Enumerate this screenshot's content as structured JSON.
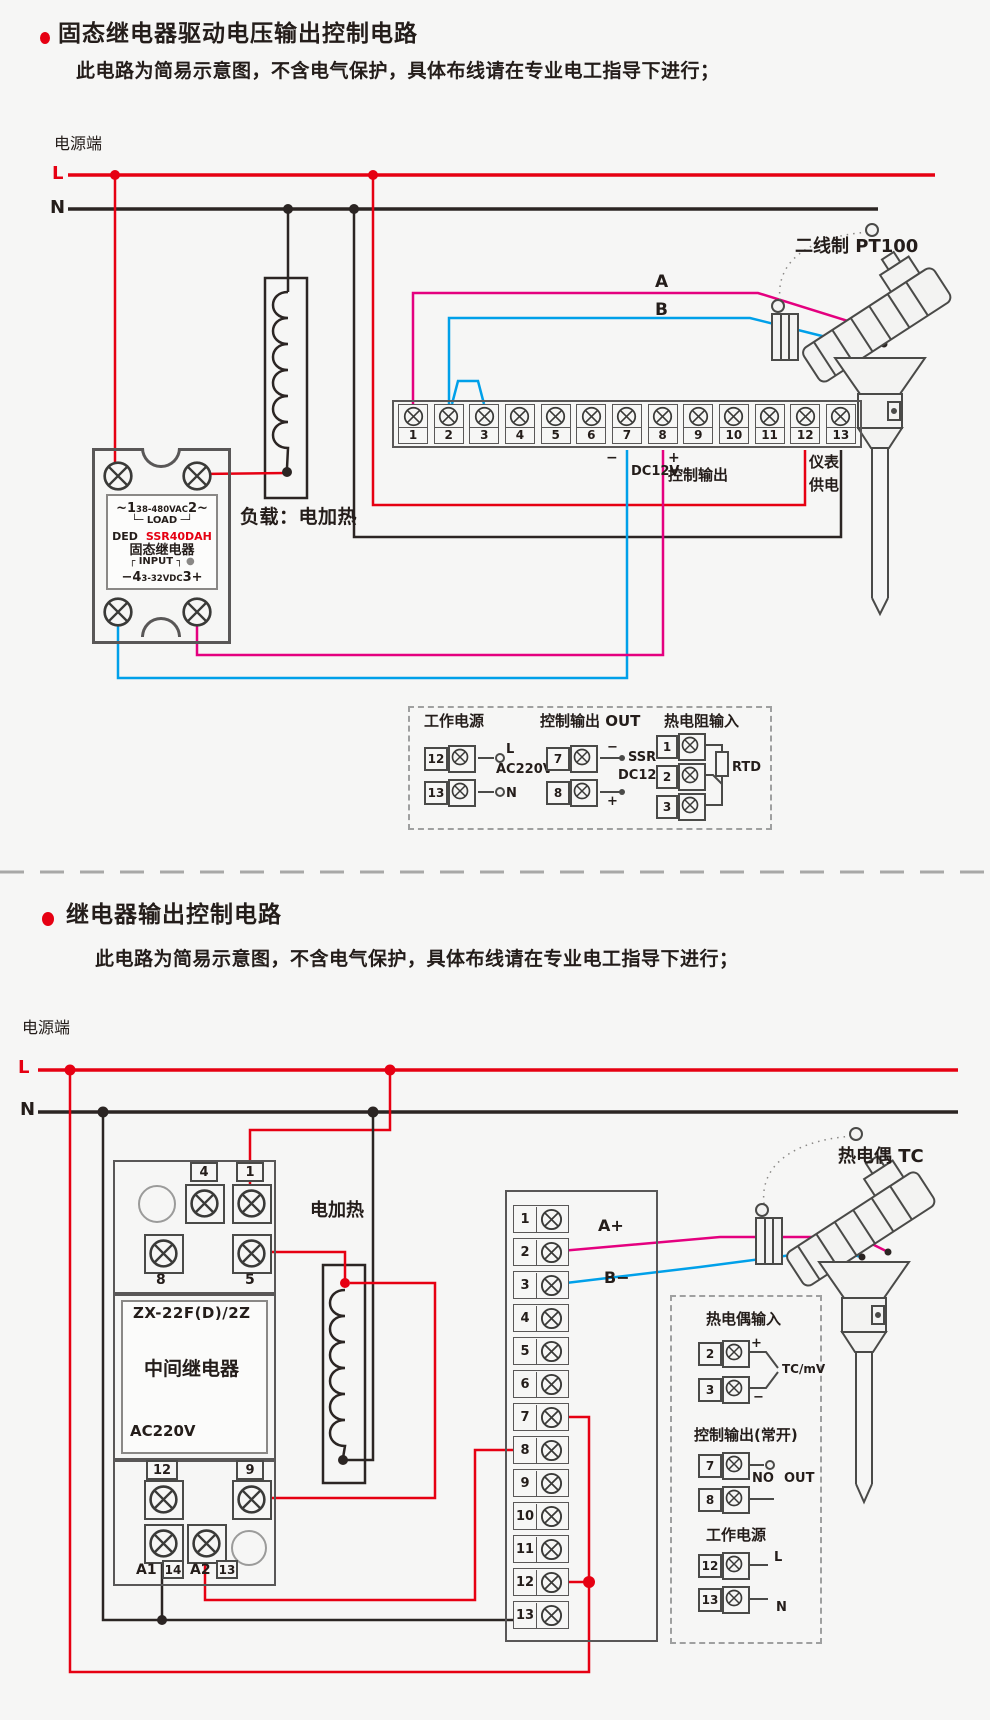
{
  "colors": {
    "accent_red": "#e60012",
    "wire_black": "#2b2523",
    "wire_magenta": "#e4007f",
    "wire_blue": "#00a0e9",
    "box_gray": "#595757",
    "background": "#f6f6f5"
  },
  "section1": {
    "title": "固态继电器驱动电压输出控制电路",
    "note": "此电路为简易示意图，不含电气保护，具体布线请在专业电工指导下进行；",
    "power_label": "电源端",
    "l_label": "L",
    "n_label": "N",
    "load_label": "负载：电加热",
    "sensor_label": "二线制 PT100",
    "ssr": {
      "line1_left": "~1",
      "line1_mid": "38-480VAC",
      "line1_right": "2~",
      "line2": "└─ LOAD ─┘",
      "brand": "DED",
      "model": "SSR40DAH",
      "name": "固态继电器",
      "line5": "┌ INPUT ┐",
      "line6_left": "−4",
      "line6_mid": "3-32VDC",
      "line6_right": "3+"
    },
    "strip": {
      "terminals": [
        "1",
        "2",
        "3",
        "4",
        "5",
        "6",
        "7",
        "8",
        "9",
        "10",
        "11",
        "12",
        "13"
      ]
    },
    "wire_labels": {
      "a": "A",
      "b": "B",
      "minus": "−",
      "plus": "+",
      "dc12v": "DC12V",
      "ctrl_out": "控制输出",
      "meter": "仪表",
      "supply": "供电"
    },
    "legend": {
      "power": {
        "title": "工作电源",
        "t1": "12",
        "t2": "13",
        "l": "L",
        "n": "N",
        "ac": "AC220V"
      },
      "out": {
        "title": "控制输出 OUT",
        "t1": "7",
        "t2": "8",
        "minus": "−",
        "plus": "+",
        "ssr": "SSR",
        "dc12v": "DC12V"
      },
      "rtd": {
        "title": "热电阻输入",
        "t1": "1",
        "t2": "2",
        "t3": "3",
        "rtd": "RTD"
      }
    }
  },
  "section2": {
    "title": "继电器输出控制电路",
    "note": "此电路为简易示意图，不含电气保护，具体布线请在专业电工指导下进行；",
    "power_label": "电源端",
    "l_label": "L",
    "n_label": "N",
    "heater_label": "电加热",
    "sensor_label": "热电偶 TC",
    "relay": {
      "top_terminals": [
        "4",
        "1"
      ],
      "mid_terminals": [
        "8",
        "5"
      ],
      "row3_terminals": [
        "12",
        "9"
      ],
      "bottom_labels": [
        "A1",
        "14",
        "A2",
        "13"
      ],
      "model": "ZX-22F(D)/2Z",
      "name": "中间继电器",
      "voltage": "AC220V"
    },
    "strip": {
      "terminals": [
        "1",
        "2",
        "3",
        "4",
        "5",
        "6",
        "7",
        "8",
        "9",
        "10",
        "11",
        "12",
        "13"
      ]
    },
    "wire_labels": {
      "a_plus": "A+",
      "b_minus": "B−"
    },
    "legend": {
      "tc": {
        "title": "热电偶输入",
        "t1": "2",
        "t2": "3",
        "plus": "+",
        "minus": "−",
        "unit": "TC/mV"
      },
      "out": {
        "title": "控制输出(常开)",
        "t1": "7",
        "t2": "8",
        "no": "NO",
        "out": "OUT"
      },
      "power": {
        "title": "工作电源",
        "t1": "12",
        "t2": "13",
        "l": "L",
        "n": "N"
      }
    }
  }
}
